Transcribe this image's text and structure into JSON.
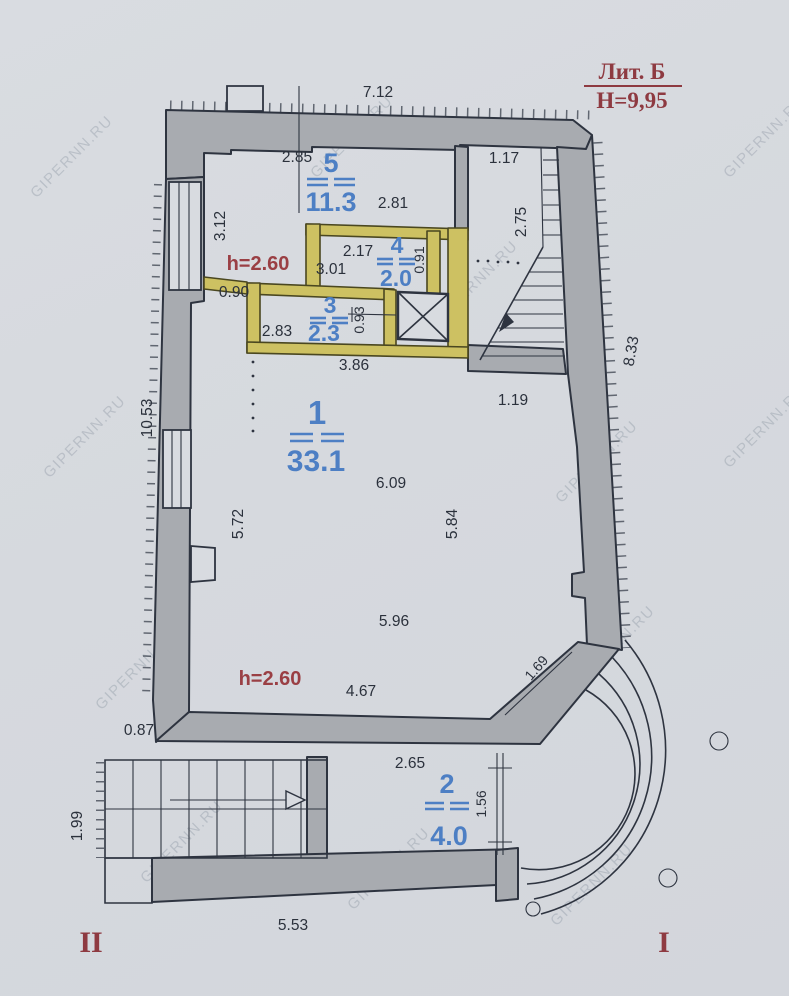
{
  "title": {
    "litera": "Лит. Б",
    "height_mark": "Н=9,95"
  },
  "watermark_text": "GIPERNN.RU",
  "entrance_marks": {
    "left": "II",
    "right": "I"
  },
  "room_heights": {
    "upper": "h=2.60",
    "lower": "h=2.60"
  },
  "rooms": {
    "r1": {
      "number": "1",
      "area": "33.1"
    },
    "r2": {
      "number": "2",
      "area": "4.0"
    },
    "r3": {
      "number": "3",
      "area": "2.3"
    },
    "r4": {
      "number": "4",
      "area": "2.0"
    },
    "r5": {
      "number": "5",
      "area": "11.3"
    }
  },
  "dimensions": {
    "d1": "7.12",
    "d2": "2.85",
    "d3": "1.17",
    "d4": "2.81",
    "d5": "3.12",
    "d6": "2.75",
    "d7": "2.17",
    "d8": "0.91",
    "d9": "3.01",
    "d10": "0.90",
    "d11": "0.93",
    "d12": "2.83",
    "d13": "3.86",
    "d14": "8.33",
    "d15": "1.19",
    "d16": "6.09",
    "d17": "10.53",
    "d18": "5.72",
    "d19": "5.84",
    "d20": "5.96",
    "d21": "1.69",
    "d22": "4.67",
    "d23": "0.87",
    "d24": "2.65",
    "d25": "1.56",
    "d26": "1.99",
    "d27": "5.53"
  },
  "colors": {
    "paper": "#d8dbe0",
    "wall_gray": "#a8abb0",
    "wall_accent_yellow": "#cdc162",
    "room_label_blue": "#4d7fc4",
    "annotation_red": "#9a3f44",
    "line_dark": "#2e3440"
  }
}
